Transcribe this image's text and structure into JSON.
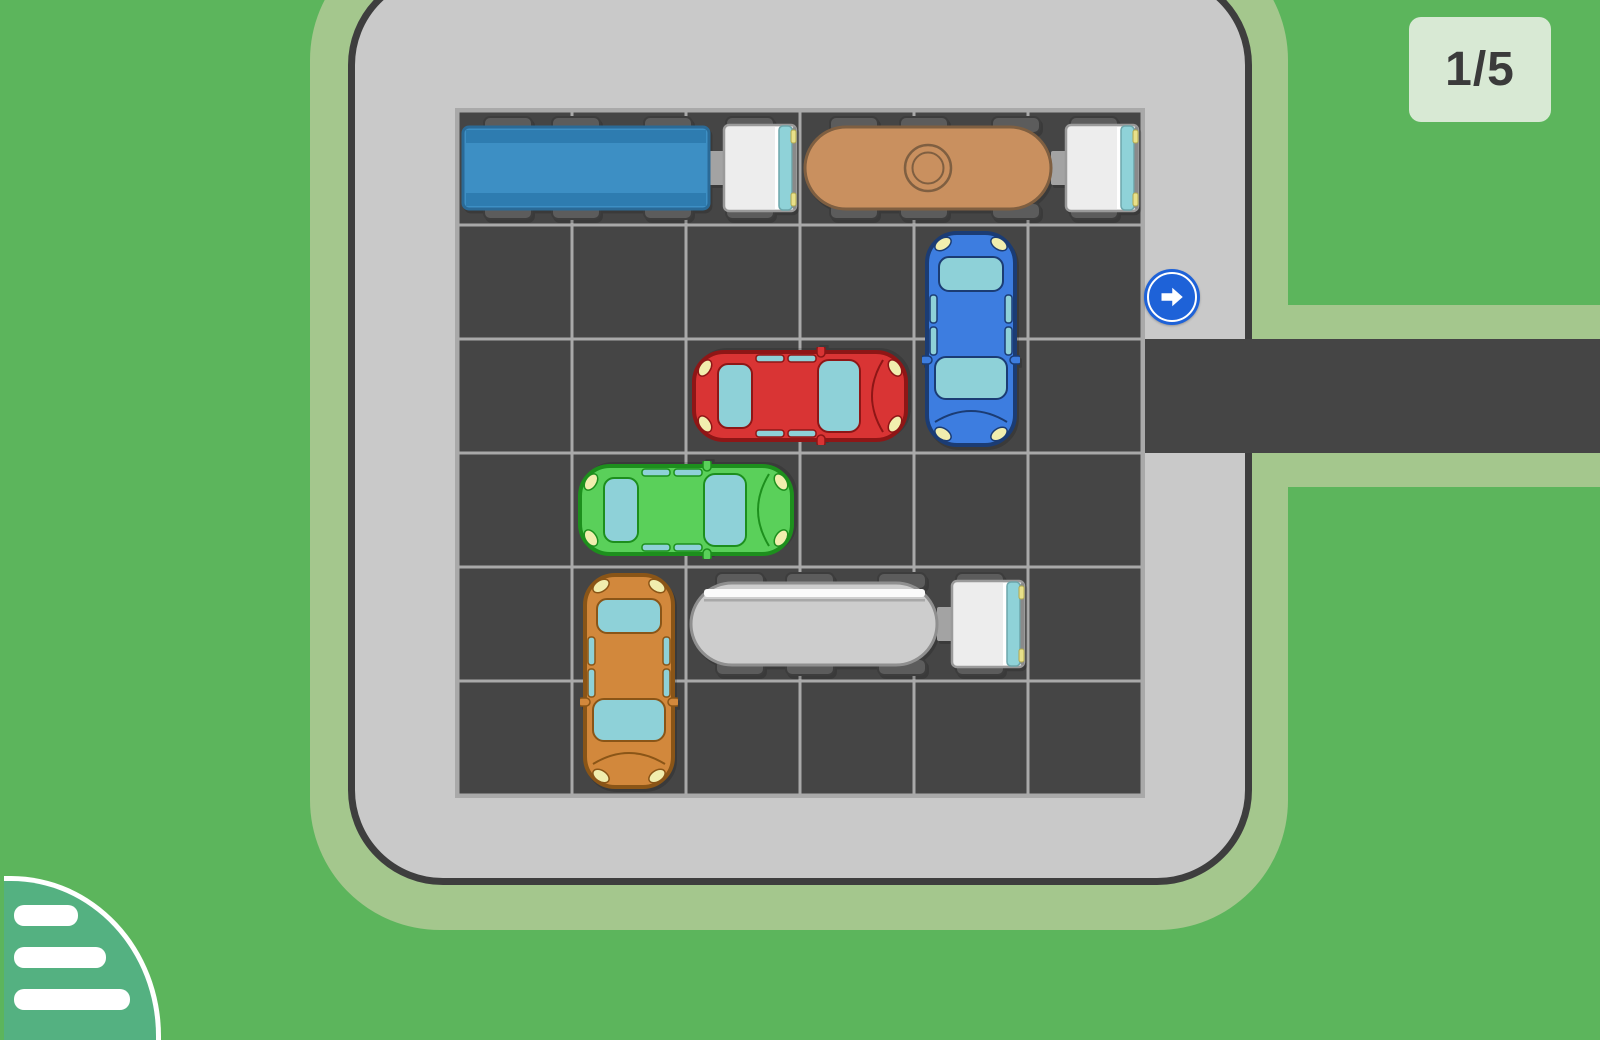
{
  "hud": {
    "level_counter": "1/5"
  },
  "palette": {
    "background_green": "#5cb55c",
    "shoulder_green": "#a4c78d",
    "lot_surface": "#c9c9c9",
    "lot_border": "#3e3e3e",
    "asphalt": "#454545",
    "grid_line": "#a9a9a9",
    "badge_bg": "#d8e9d4",
    "badge_text": "#3b3b3b",
    "arrow_sign_blue": "#1e62d8",
    "menu_button_green": "#54b181",
    "window_glass": "#8ed1d8",
    "vehicle_light": "#f1eeae"
  },
  "board": {
    "cols": 6,
    "rows": 6,
    "exit": {
      "row": 2,
      "side": "right",
      "icon": "arrow-right"
    },
    "vehicles": [
      {
        "name": "blue-box-truck",
        "type": "truck",
        "col": 0,
        "row": 0,
        "len": 3,
        "dir": "h",
        "colors": {
          "cargo": "#3d8fc4",
          "cargoDark": "#2e7cb0",
          "line": "#2a6a97"
        }
      },
      {
        "name": "tan-tanker-truck",
        "type": "tanker-cap",
        "col": 3,
        "row": 0,
        "len": 3,
        "dir": "h",
        "colors": {
          "tank": "#c9905f",
          "line": "#7f5f41"
        }
      },
      {
        "name": "blue-car",
        "type": "car",
        "col": 4,
        "row": 1,
        "len": 2,
        "dir": "v",
        "colors": {
          "body": "#3d7de0",
          "line": "#1b3c74"
        }
      },
      {
        "name": "red-car",
        "type": "car",
        "col": 2,
        "row": 2,
        "len": 2,
        "dir": "h",
        "colors": {
          "body": "#d93434",
          "line": "#8e1616"
        }
      },
      {
        "name": "green-car",
        "type": "car",
        "col": 1,
        "row": 3,
        "len": 2,
        "dir": "h",
        "colors": {
          "body": "#5ad05a",
          "line": "#1d8f1d"
        }
      },
      {
        "name": "orange-car",
        "type": "car",
        "col": 1,
        "row": 4,
        "len": 2,
        "dir": "v",
        "colors": {
          "body": "#d2883c",
          "line": "#8a5517"
        }
      },
      {
        "name": "gray-tanker-truck",
        "type": "tanker-stripe",
        "col": 2,
        "row": 4,
        "len": 3,
        "dir": "h",
        "colors": {
          "tank": "#cdcdcd",
          "line": "#8f8f8f"
        }
      }
    ]
  }
}
